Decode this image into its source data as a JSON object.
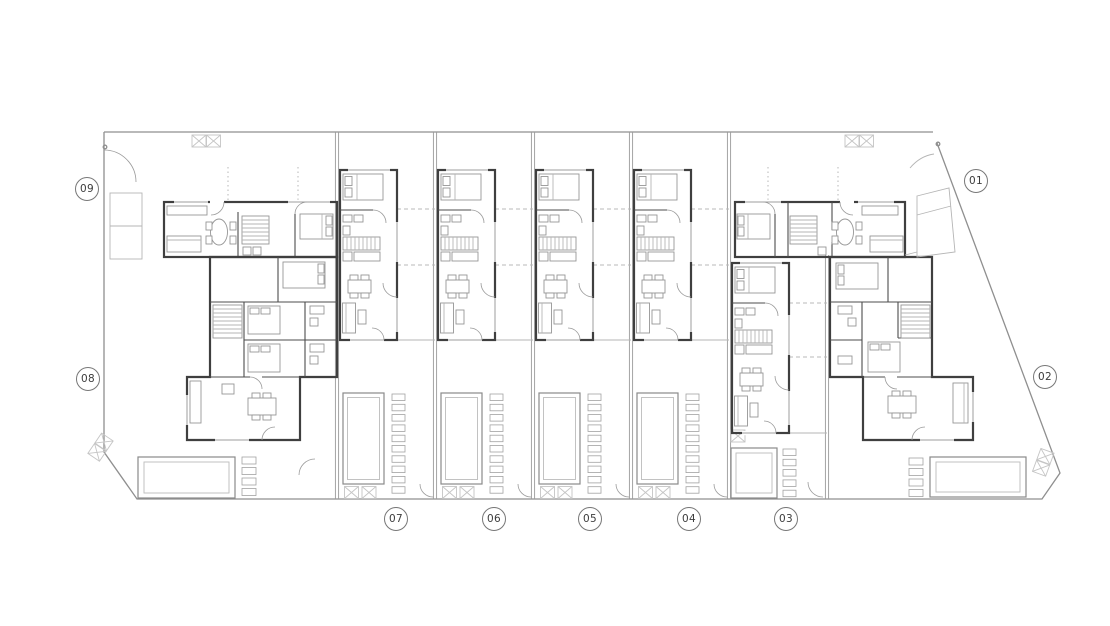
{
  "drawing": {
    "kind": "architectural-floor-plan",
    "description": "Ground floor site plan of a terraced housing development with nine units, private pools, decked terraces and party walls"
  },
  "units": [
    {
      "id": "unit-01",
      "label": "01"
    },
    {
      "id": "unit-02",
      "label": "02"
    },
    {
      "id": "unit-03",
      "label": "03"
    },
    {
      "id": "unit-04",
      "label": "04"
    },
    {
      "id": "unit-05",
      "label": "05"
    },
    {
      "id": "unit-06",
      "label": "06"
    },
    {
      "id": "unit-07",
      "label": "07"
    },
    {
      "id": "unit-08",
      "label": "08"
    },
    {
      "id": "unit-09",
      "label": "09"
    }
  ],
  "palette": {
    "house_wall": "#3f3f3f",
    "site_boundary": "#8f8f8f",
    "party_wall": "#9a9a9a",
    "furniture": "#969696",
    "pool_edge": "#8a8a8a",
    "pool_inner": "#bcbcbc",
    "deck_strip": "#a2a2a2",
    "vent_box": "#c5c5c5",
    "label_ring": "#777777",
    "label_text": "#3c3c3c",
    "background": "#ffffff"
  }
}
